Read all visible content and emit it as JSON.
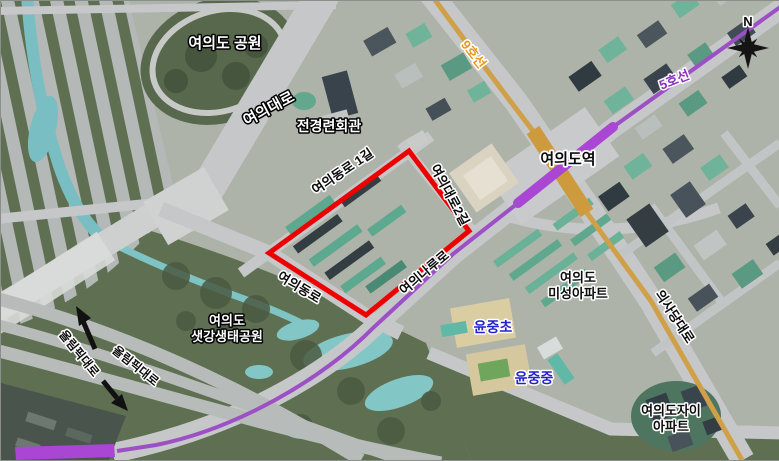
{
  "map": {
    "labels": {
      "park": "여의도 공원",
      "yeouidaero": "여의대로",
      "fki_building": "전경련회관",
      "yeouidong_ro_1gil": "여의동로 1길",
      "yeouidaero_2gil": "여의대로2길",
      "line9": "9호선",
      "line5": "5호선",
      "yeouido_station": "여의도역",
      "yeouidong_ro": "여의동로",
      "yeouinaru_ro": "여의나루로",
      "uisadang_daero": "의사당대로",
      "misung_apt_line1": "여의도",
      "misung_apt_line2": "미성아파트",
      "yunjung_elementary": "윤중초",
      "yunjung_middle": "윤중중",
      "saetgang_line1": "여의도",
      "saetgang_line2": "샛강생태공원",
      "olympic_daero_west": "올림픽대로",
      "olympic_daero_east": "올림픽대로",
      "jai_apt_line1": "여의도자이",
      "jai_apt_line2": "아파트",
      "compass_north": "N"
    },
    "colors": {
      "site_boundary": "#ee0000",
      "line5": "#9d4fc5",
      "line5_station": "#aa46d4",
      "line9": "#cfa048",
      "line9_station": "#cd9a3e",
      "line9_label": "#e8991a",
      "line5_label": "#8b2dbe",
      "school_label": "#2323cc"
    }
  }
}
